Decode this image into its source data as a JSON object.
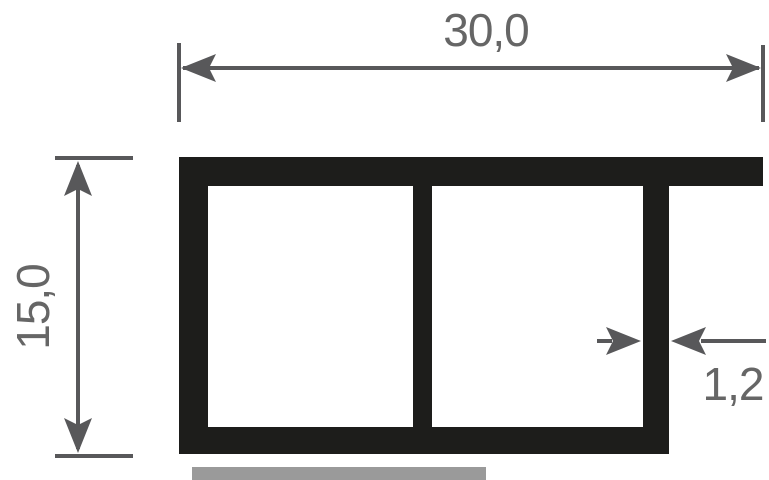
{
  "drawing": {
    "dimensions": {
      "width": {
        "label": "30,0"
      },
      "height": {
        "label": "15,0"
      },
      "thickness": {
        "label": "1,2"
      }
    },
    "colors": {
      "profile": "#1d1d1b",
      "dimension_lines": "#58585a",
      "labels": "#666666",
      "ground_strip": "#9a9a9a",
      "background": "#ffffff"
    }
  }
}
